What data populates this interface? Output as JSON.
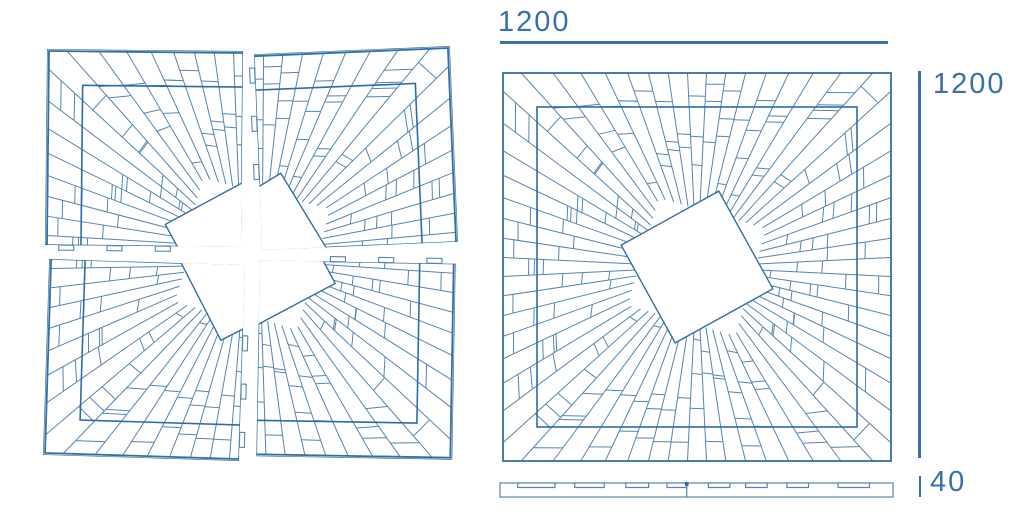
{
  "diagram": {
    "type": "parquet-medallion-technical-drawing",
    "views": [
      {
        "id": "exploded",
        "name": "Exploded view of four quadrant panels"
      },
      {
        "id": "assembled",
        "name": "Assembled top view"
      },
      {
        "id": "profile",
        "name": "Side profile section"
      }
    ],
    "dimensions": {
      "width": "1200",
      "height": "1200",
      "thickness": "40"
    },
    "colors": {
      "line": "#5584b4",
      "bold": "#2e6ba8",
      "outline": "#336ea6",
      "dimension": "#3a70a8",
      "background": "#ffffff"
    },
    "pattern": {
      "size": 392,
      "rays": 64,
      "center_square_rotation_deg": 16,
      "center_square_circumradius": 79,
      "inner_border_inset": 36,
      "outer_edge_inset": 2,
      "seed": 7,
      "quadrant_gap": 16,
      "quadrant_rotations_deg": [
        0.6,
        -2.4,
        1.8,
        1.0
      ],
      "tabs_per_edge": 3,
      "tab_length": 15,
      "tab_depth": 5
    },
    "profile": {
      "slot_count": 8,
      "seam_fraction": 0.475
    }
  }
}
